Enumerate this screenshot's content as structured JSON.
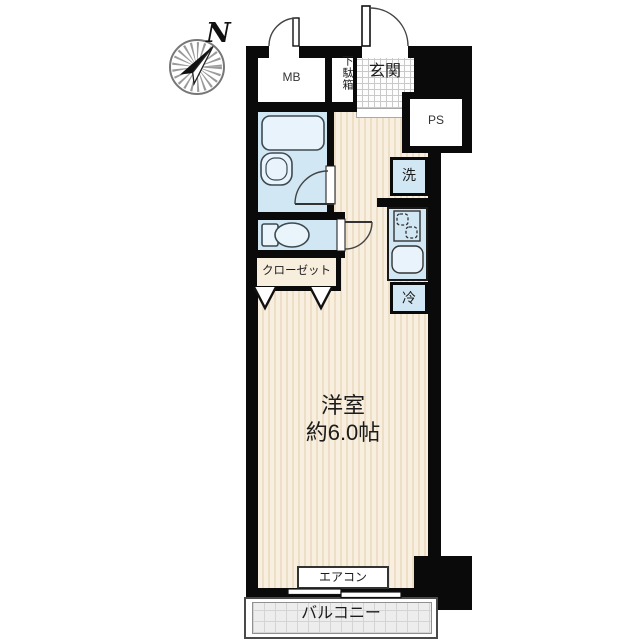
{
  "compass": {
    "north_label": "N"
  },
  "labels": {
    "mb": "MB",
    "shoe_cabinet": "下駄箱",
    "entrance": "玄関",
    "pipe_space": "PS",
    "washer": "洗",
    "refrigerator": "冷",
    "closet": "クローゼット",
    "room_name": "洋室",
    "room_size": "約6.0帖",
    "aircon": "エアコン",
    "balcony": "バルコニー"
  },
  "colors": {
    "wall": "#0a0a0a",
    "water_area_fill": "#d2e7f4",
    "fixture_fill": "#e8f3fb",
    "floor_fill": "#f8efe0",
    "floor_stripe": "#ecdfc6",
    "balcony_fill": "#ededed",
    "outline": "#333333"
  }
}
